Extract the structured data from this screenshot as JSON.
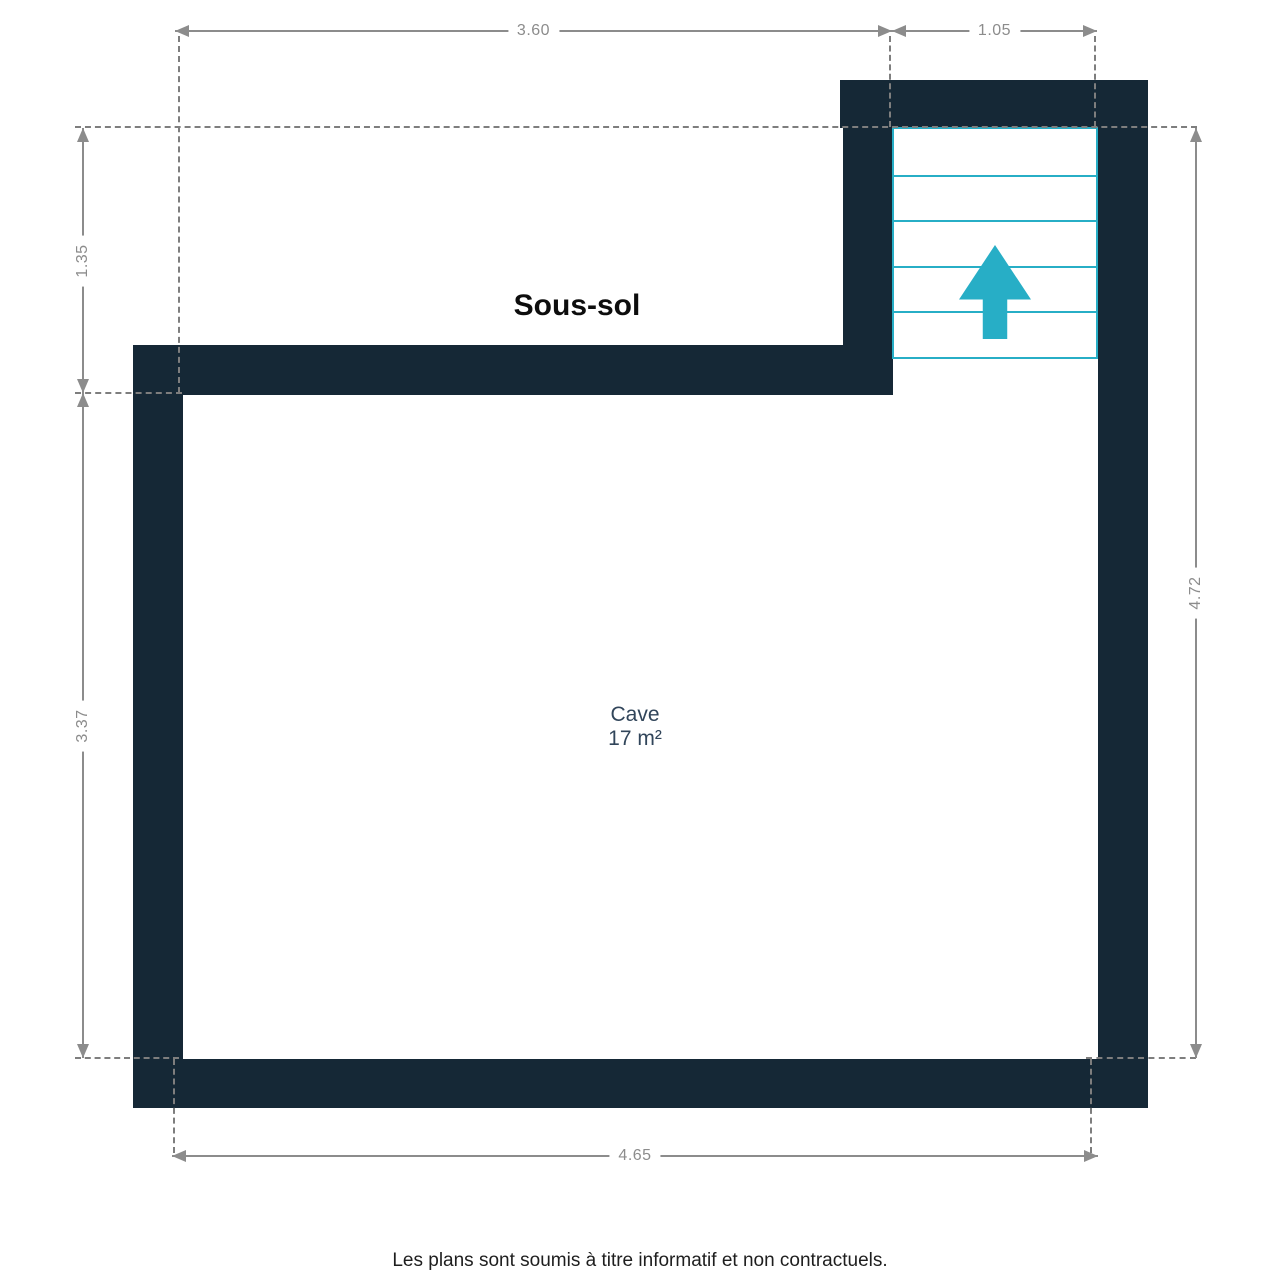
{
  "floor_plan": {
    "floor_label": "Sous-sol",
    "room": {
      "name": "Cave",
      "area": "17 m²"
    },
    "stairs": {
      "symbol": "up-arrow",
      "step_count": 5
    },
    "dimensions": {
      "top": [
        {
          "value": "3.60"
        },
        {
          "value": "1.05"
        }
      ],
      "left": [
        {
          "value": "1.35"
        },
        {
          "value": "3.37"
        }
      ],
      "right": [
        {
          "value": "4.72"
        }
      ],
      "bottom": [
        {
          "value": "4.65"
        }
      ]
    },
    "colors": {
      "wall": "#152836",
      "accent": "#27aec6",
      "dimension": "#8c8c8c",
      "dashed": "#7e7e7e",
      "room-text": "#31455a"
    }
  },
  "footer": {
    "disclaimer": "Les plans sont soumis à titre informatif et non contractuels."
  }
}
